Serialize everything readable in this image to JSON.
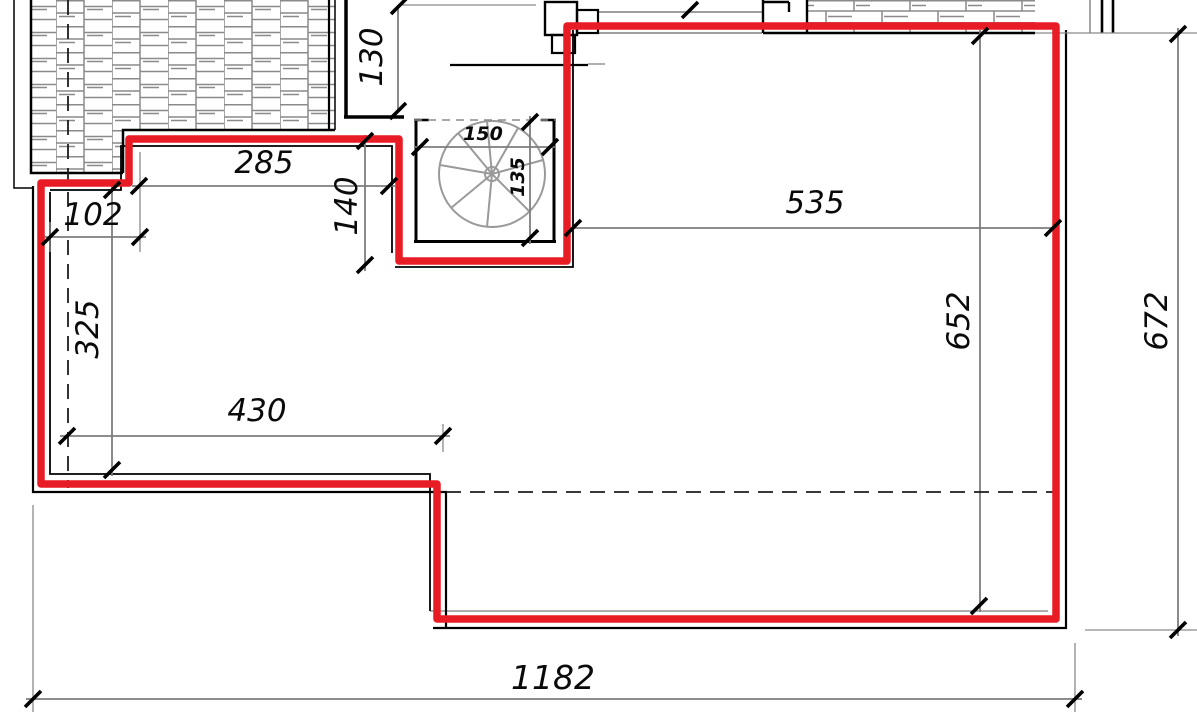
{
  "drawing": {
    "title": "roof terrace plan with highlighted perimeter",
    "colors": {
      "highlight_red": "#e81c24",
      "wall_black": "#000000",
      "dimension_gray": "#7d7d7d",
      "hatch_gray": "#8a8a8a"
    },
    "dimensions": {
      "d130": "130",
      "d285": "285",
      "d102": "102",
      "d150": "150",
      "d135": "135",
      "d140": "140",
      "d535": "535",
      "d652": "652",
      "d672": "672",
      "d325": "325",
      "d430": "430",
      "d1182": "1182"
    },
    "symbols": {
      "spiral_stair": "spiral-staircase",
      "brick_hatch": "brick-paving-hatch",
      "chimney": "chimney-shaft"
    }
  }
}
